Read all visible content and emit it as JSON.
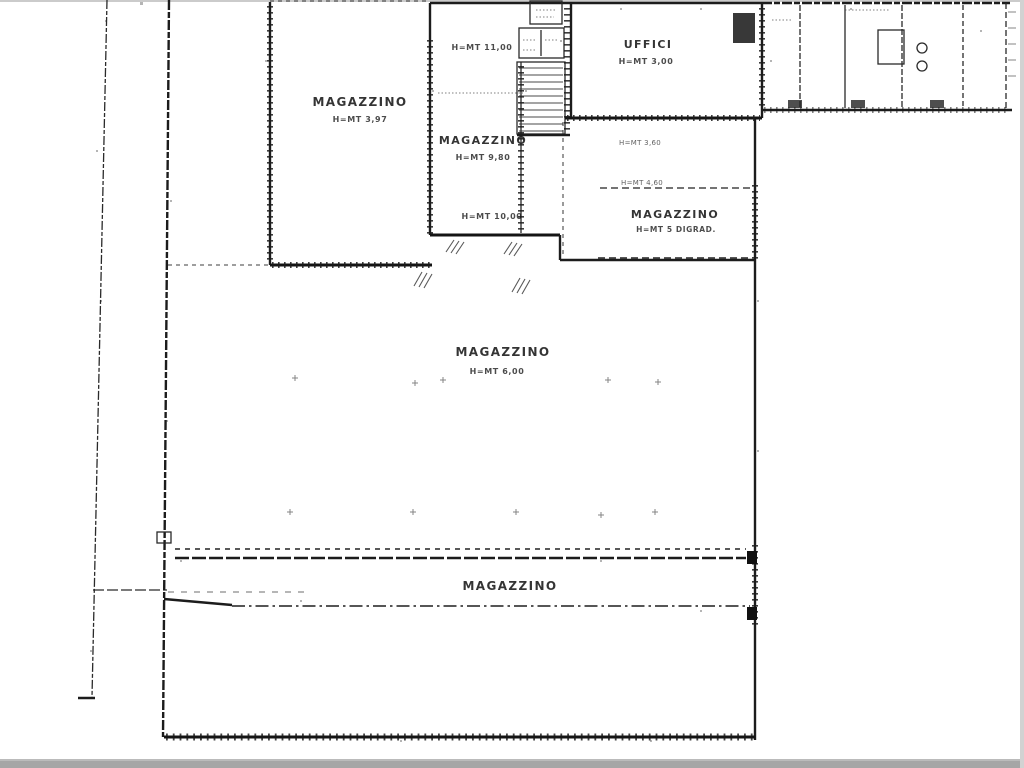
{
  "scan": {
    "ink_color": "#1a1a1a",
    "paper_color": "#ffffff",
    "edge_color": "#a6a6a6"
  },
  "rooms": {
    "magazzino_top_left": {
      "label": "MAGAZZINO",
      "height": "H=MT 3,97"
    },
    "magazzino_middle": {
      "height_top": "H=MT 11,00",
      "label": "MAGAZZINO",
      "height": "H=MT 9,80",
      "height_bottom": "H=MT 10,00"
    },
    "uffici": {
      "label": "UFFICI",
      "height": "H=MT 3,00"
    },
    "magazzino_right": {
      "note_upper": "H=MT 3,60",
      "note_lower": "H=MT 4,60",
      "label": "MAGAZZINO",
      "height": "H=MT 5 DIGRAD."
    },
    "magazzino_central": {
      "label": "MAGAZZINO",
      "height": "H=MT 6,00"
    },
    "magazzino_bottom": {
      "label": "MAGAZZINO"
    }
  }
}
